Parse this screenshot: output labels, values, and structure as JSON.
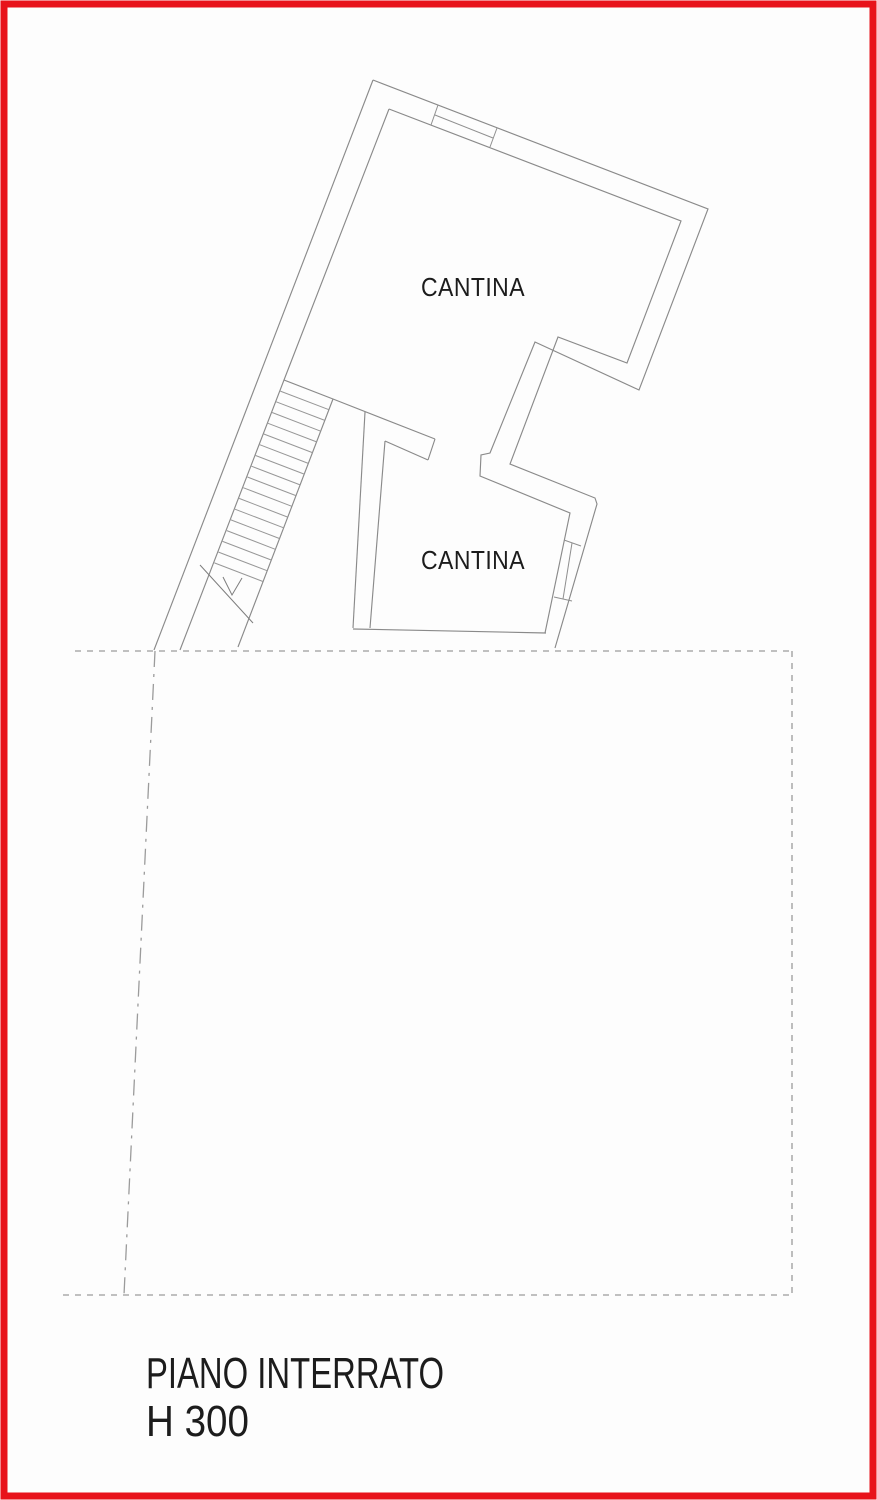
{
  "colors": {
    "border_red": "#e8131b",
    "wall_line": "#8a8a8a",
    "boundary_line": "#9b9b9b",
    "text": "#1c1c1c",
    "background": "#fdfdfd"
  },
  "labels": {
    "room_upper": "CANTINA",
    "room_lower": "CANTINA"
  },
  "caption": {
    "floor": "PIANO INTERRATO",
    "height": "H 300"
  }
}
